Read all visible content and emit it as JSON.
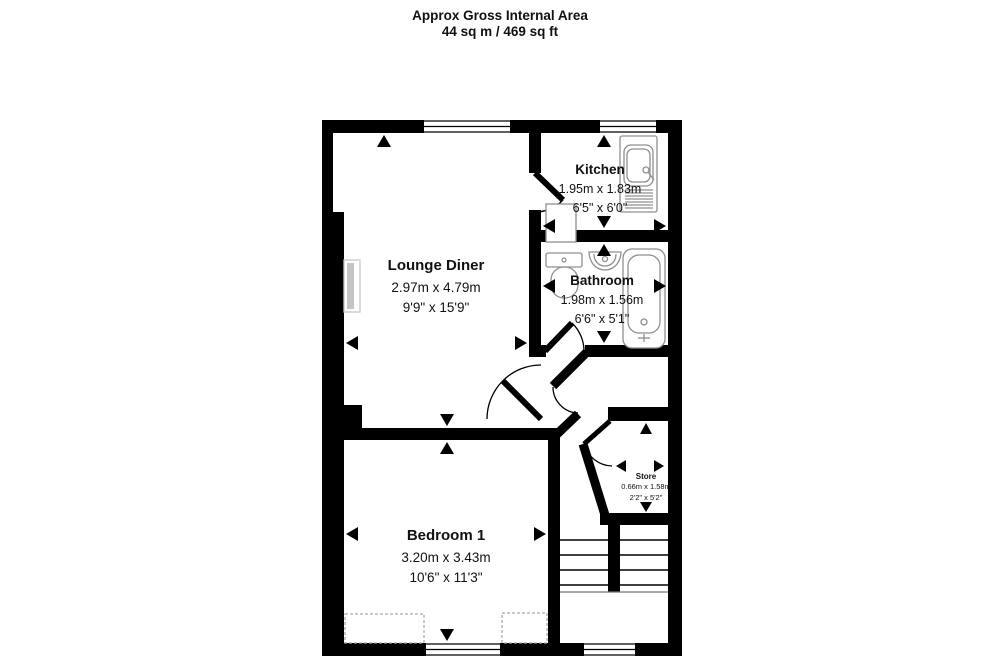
{
  "header": {
    "line1": "Approx Gross Internal Area",
    "line2": "44 sq m / 469 sq ft"
  },
  "rooms": {
    "lounge": {
      "name": "Lounge Diner",
      "metric": "2.97m x 4.79m",
      "imperial": "9'9\" x 15'9\""
    },
    "kitchen": {
      "name": "Kitchen",
      "metric": "1.95m x 1.83m",
      "imperial": "6'5\" x 6'0\""
    },
    "bathroom": {
      "name": "Bathroom",
      "metric": "1.98m x 1.56m",
      "imperial": "6'6\" x 5'1\""
    },
    "bedroom": {
      "name": "Bedroom 1",
      "metric": "3.20m x 3.43m",
      "imperial": "10'6\" x 11'3\""
    },
    "store": {
      "name": "Store",
      "metric": "0.66m x 1.58m",
      "imperial": "2'2\" x 5'2\""
    }
  },
  "colors": {
    "wall": "#000000",
    "fixture": "#8f8f8f",
    "background": "#ffffff"
  }
}
